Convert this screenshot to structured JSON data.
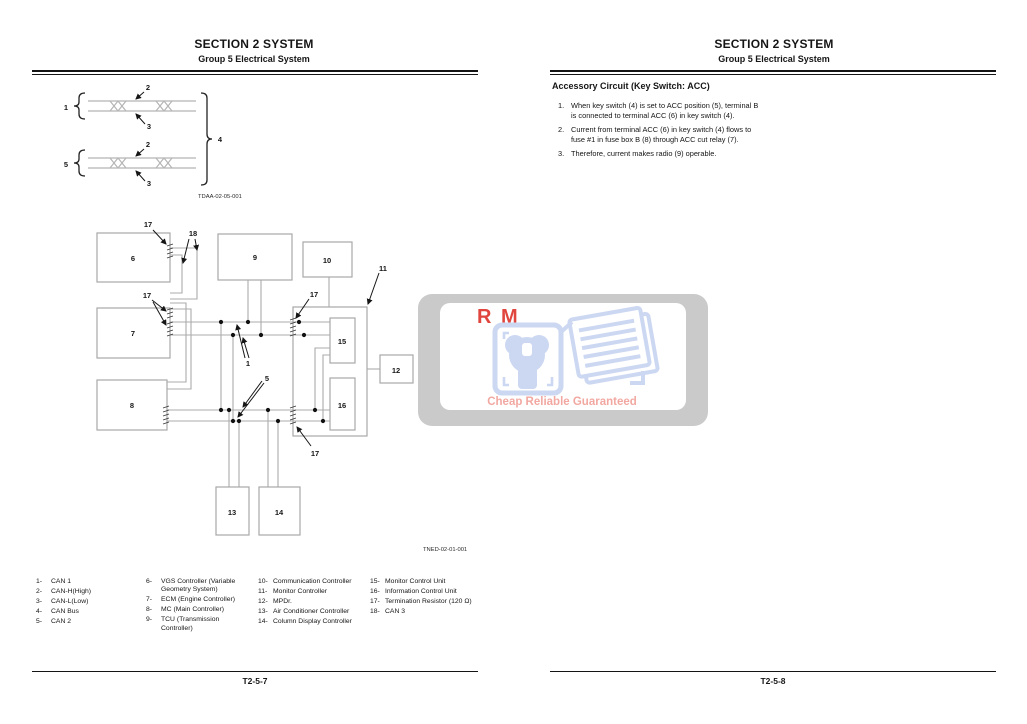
{
  "left_page": {
    "header": {
      "title": "SECTION 2 SYSTEM",
      "subtitle": "Group 5 Electrical System"
    },
    "fig1": {
      "code": "TDAA-02-05-001",
      "callouts": {
        "c1": "1",
        "c2": "2",
        "c3": "3",
        "c4": "4",
        "c5": "5"
      }
    },
    "fig2": {
      "code": "TNED-02-01-001",
      "boxes": {
        "b6": "6",
        "b7": "7",
        "b8": "8",
        "b9": "9",
        "b10": "10",
        "b12": "12",
        "b13": "13",
        "b14": "14",
        "b15": "15",
        "b16": "16"
      },
      "callouts": {
        "c1": "1",
        "c5": "5",
        "c11": "11",
        "c17": "17",
        "c18": "18"
      }
    },
    "legend": {
      "col1": [
        {
          "num": "1-",
          "label": "CAN 1"
        },
        {
          "num": "2-",
          "label": "CAN-H(High)"
        },
        {
          "num": "3-",
          "label": "CAN-L(Low)"
        },
        {
          "num": "4-",
          "label": "CAN Bus"
        },
        {
          "num": "5-",
          "label": "CAN 2"
        }
      ],
      "col2": [
        {
          "num": "6-",
          "label": "VGS Controller (Variable Geometry System)"
        },
        {
          "num": "7-",
          "label": "ECM (Engine Controller)"
        },
        {
          "num": "8-",
          "label": "MC (Main Controller)"
        },
        {
          "num": "9-",
          "label": "TCU (Transmission Controller)"
        }
      ],
      "col3": [
        {
          "num": "10-",
          "label": "Communication Controller"
        },
        {
          "num": "11-",
          "label": "Monitor Controller"
        },
        {
          "num": "12-",
          "label": "MPDr."
        },
        {
          "num": "13-",
          "label": "Air Conditioner Controller"
        },
        {
          "num": "14-",
          "label": "Column Display Controller"
        }
      ],
      "col4": [
        {
          "num": "15-",
          "label": "Monitor Control Unit"
        },
        {
          "num": "16-",
          "label": "Information Control Unit"
        },
        {
          "num": "17-",
          "label": "Termination Resistor (120 Ω)"
        },
        {
          "num": "18-",
          "label": "CAN 3"
        }
      ]
    },
    "footer": "T2-5-7"
  },
  "right_page": {
    "header": {
      "title": "SECTION 2 SYSTEM",
      "subtitle": "Group 5 Electrical System"
    },
    "section_heading": "Accessory Circuit (Key Switch: ACC)",
    "list": [
      {
        "num": "1.",
        "text": "When key switch (4) is set to ACC position (5), terminal B is connected to terminal ACC (6) in key switch (4)."
      },
      {
        "num": "2.",
        "text": "Current from terminal ACC (6) in key switch (4) flows to fuse #1 in fuse box B (8) through ACC cut relay (7)."
      },
      {
        "num": "3.",
        "text": "Therefore, current makes radio (9) operable."
      }
    ],
    "footer": "T2-5-8"
  },
  "watermark": {
    "brand_left": "R",
    "brand_right": "M",
    "tagline": "Cheap Reliable Guaranteed",
    "colors": {
      "panel": "#c6c6c6",
      "logo_blue": "#ccd7f2",
      "brand_red": "#e0453e",
      "tagline_red": "#f2a8a1"
    }
  }
}
